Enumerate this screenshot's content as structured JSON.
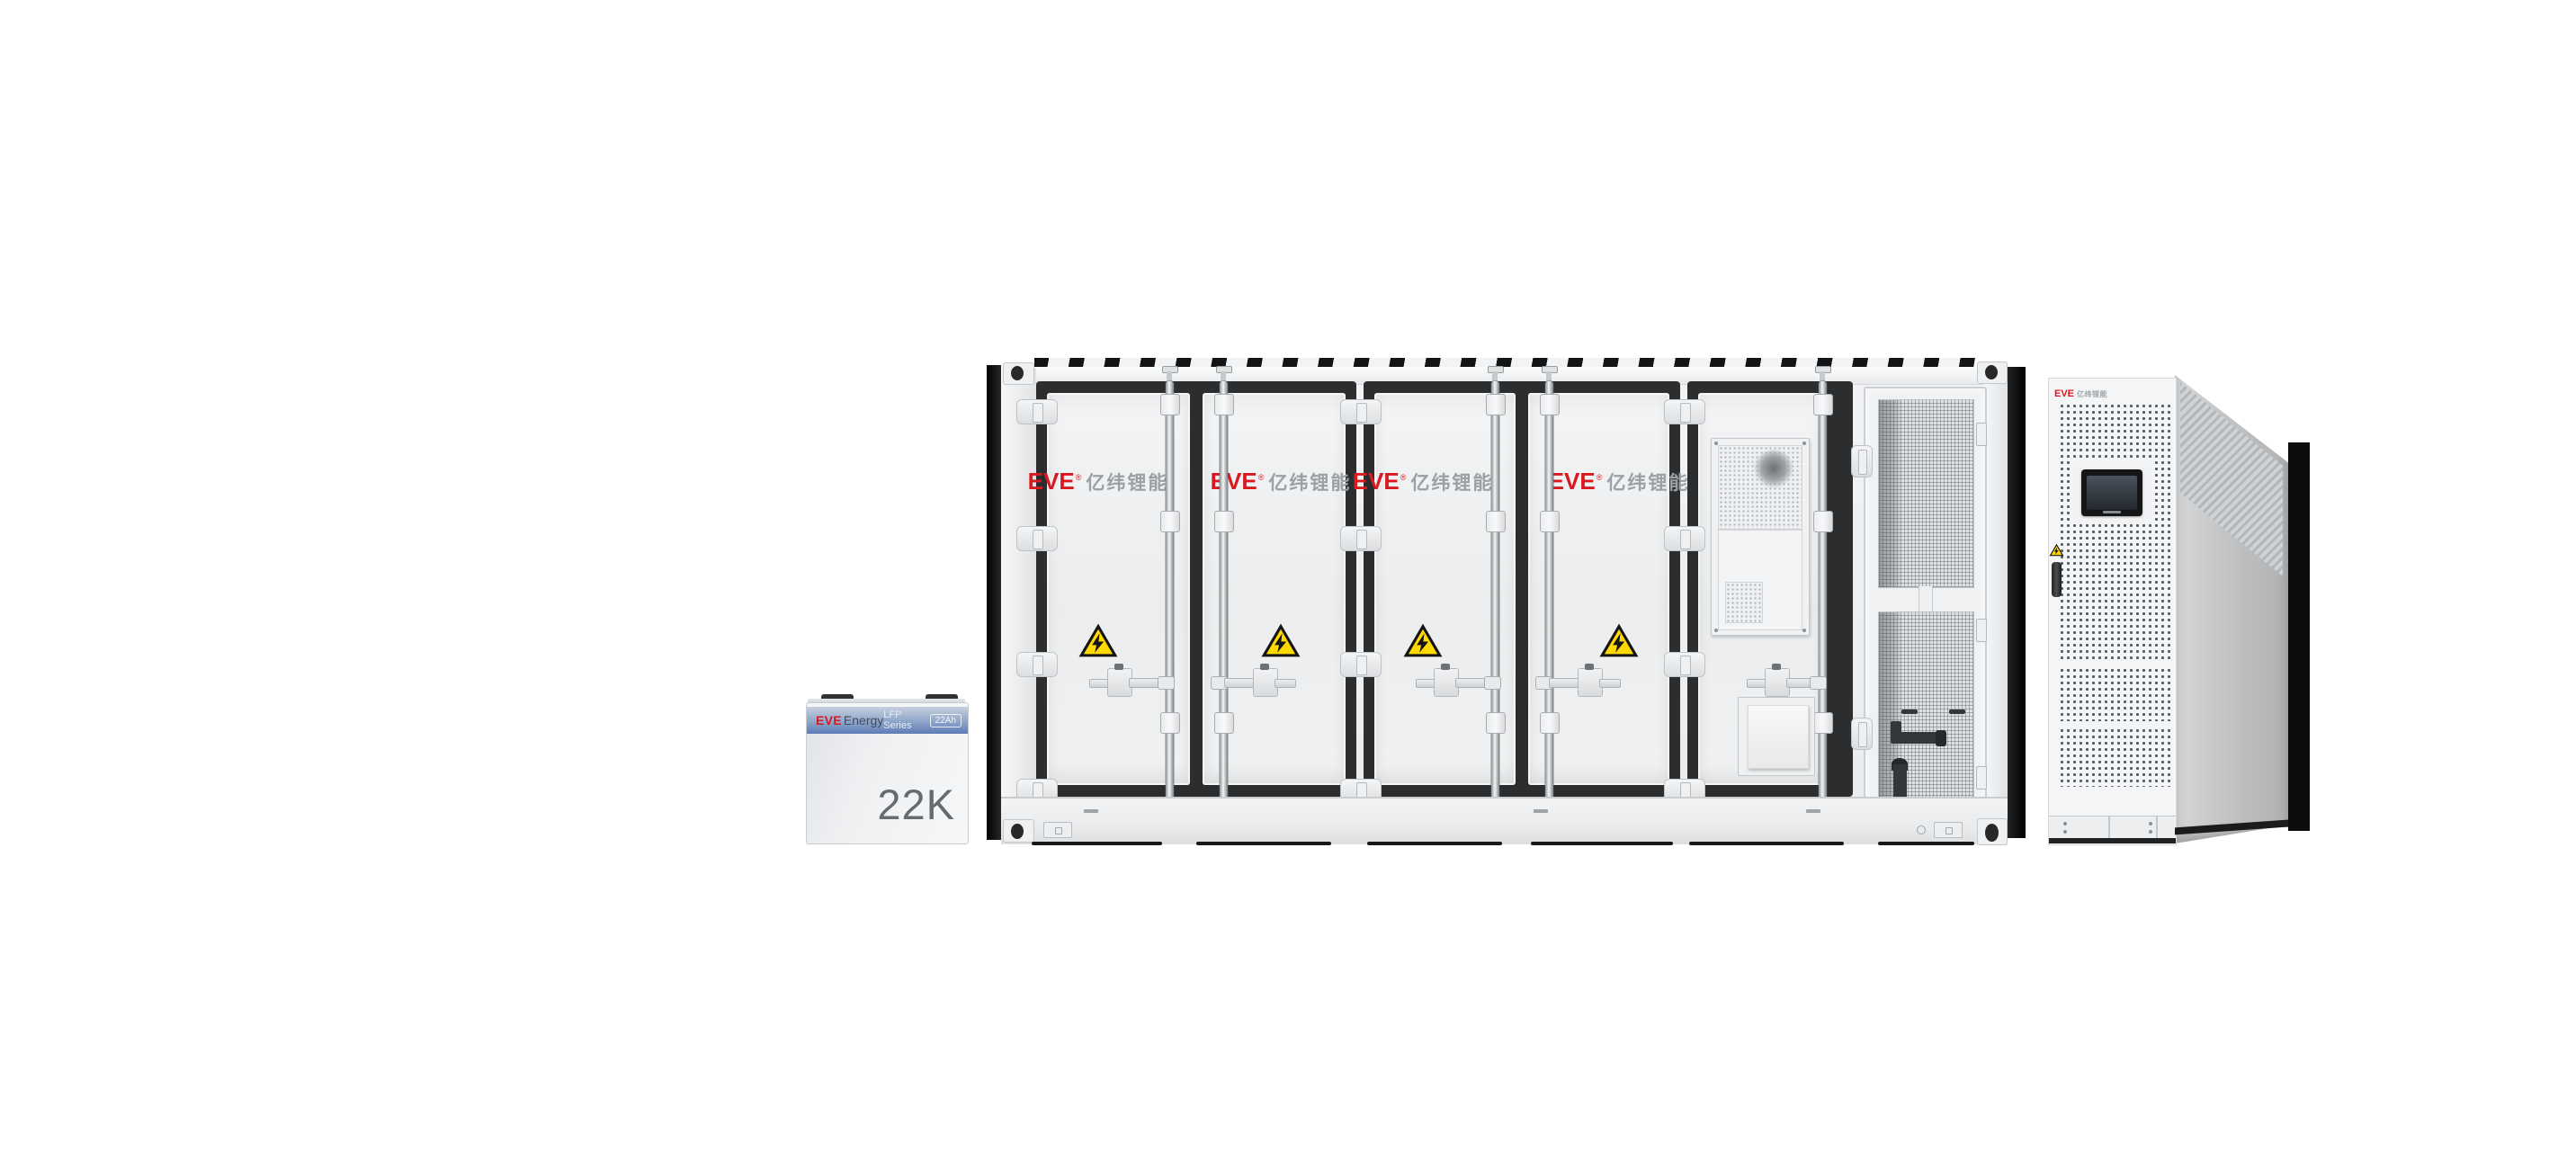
{
  "battery_unit": {
    "brand_latin": "EVE",
    "brand_suffix": "Energy",
    "series_label": "LFP Series",
    "capacity_badge": "22Ah",
    "model_label": "22K"
  },
  "container_unit": {
    "logo": {
      "latin": "EVE",
      "reg": "®",
      "cn": "亿纬锂能"
    }
  },
  "pcs_unit": {
    "logo_latin": "EVE",
    "logo_cn": "亿纬锂能"
  },
  "colors": {
    "brand_red": "#d8191f",
    "logo_gray": "#9ba0a5",
    "warning_yellow": "#ffd900",
    "battery_header_blue": "#5d7bb6",
    "frame_black": "#2b2d2f",
    "background": "#ffffff"
  }
}
